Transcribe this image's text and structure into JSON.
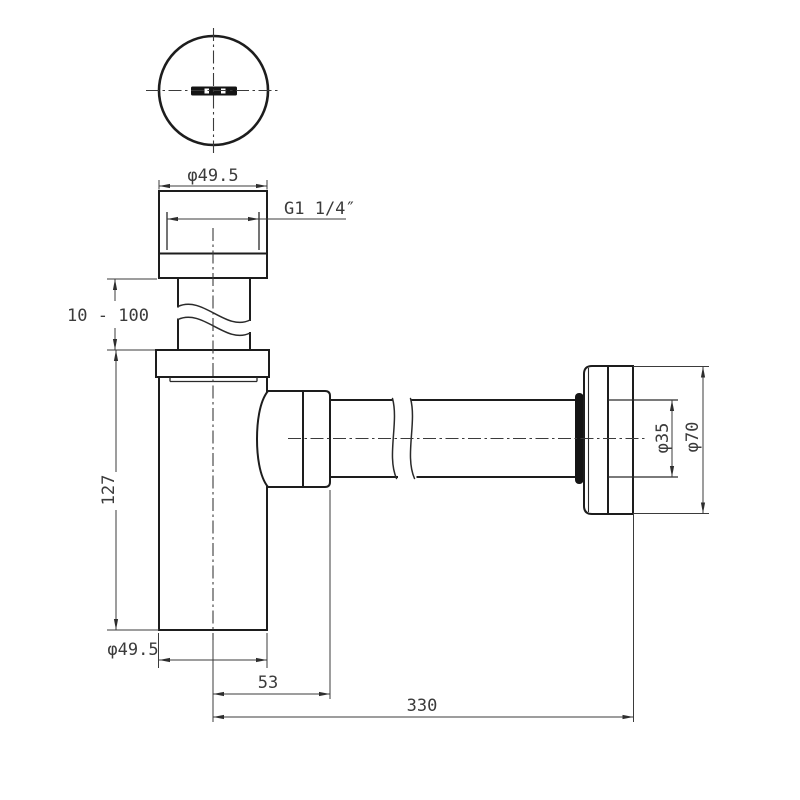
{
  "drawing": {
    "kind": "bottle trap plumbing technical drawing",
    "colors": {
      "line": "#1d1d1d",
      "dimension_line": "#3b3b3b",
      "text": "#3b3b3b",
      "background": "#ffffff"
    },
    "top_view": {
      "diameter_label": "φ49.5"
    },
    "front_view": {
      "thread_label": "G1 1/4″",
      "inlet_adjust_label": "10 - 100",
      "body_height_label": "127",
      "body_diameter_label": "φ49.5",
      "outlet_offset_label": "53",
      "pipe_length_label": "330",
      "pipe_diameter_label": "φ35",
      "flange_diameter_label": "φ70"
    }
  }
}
